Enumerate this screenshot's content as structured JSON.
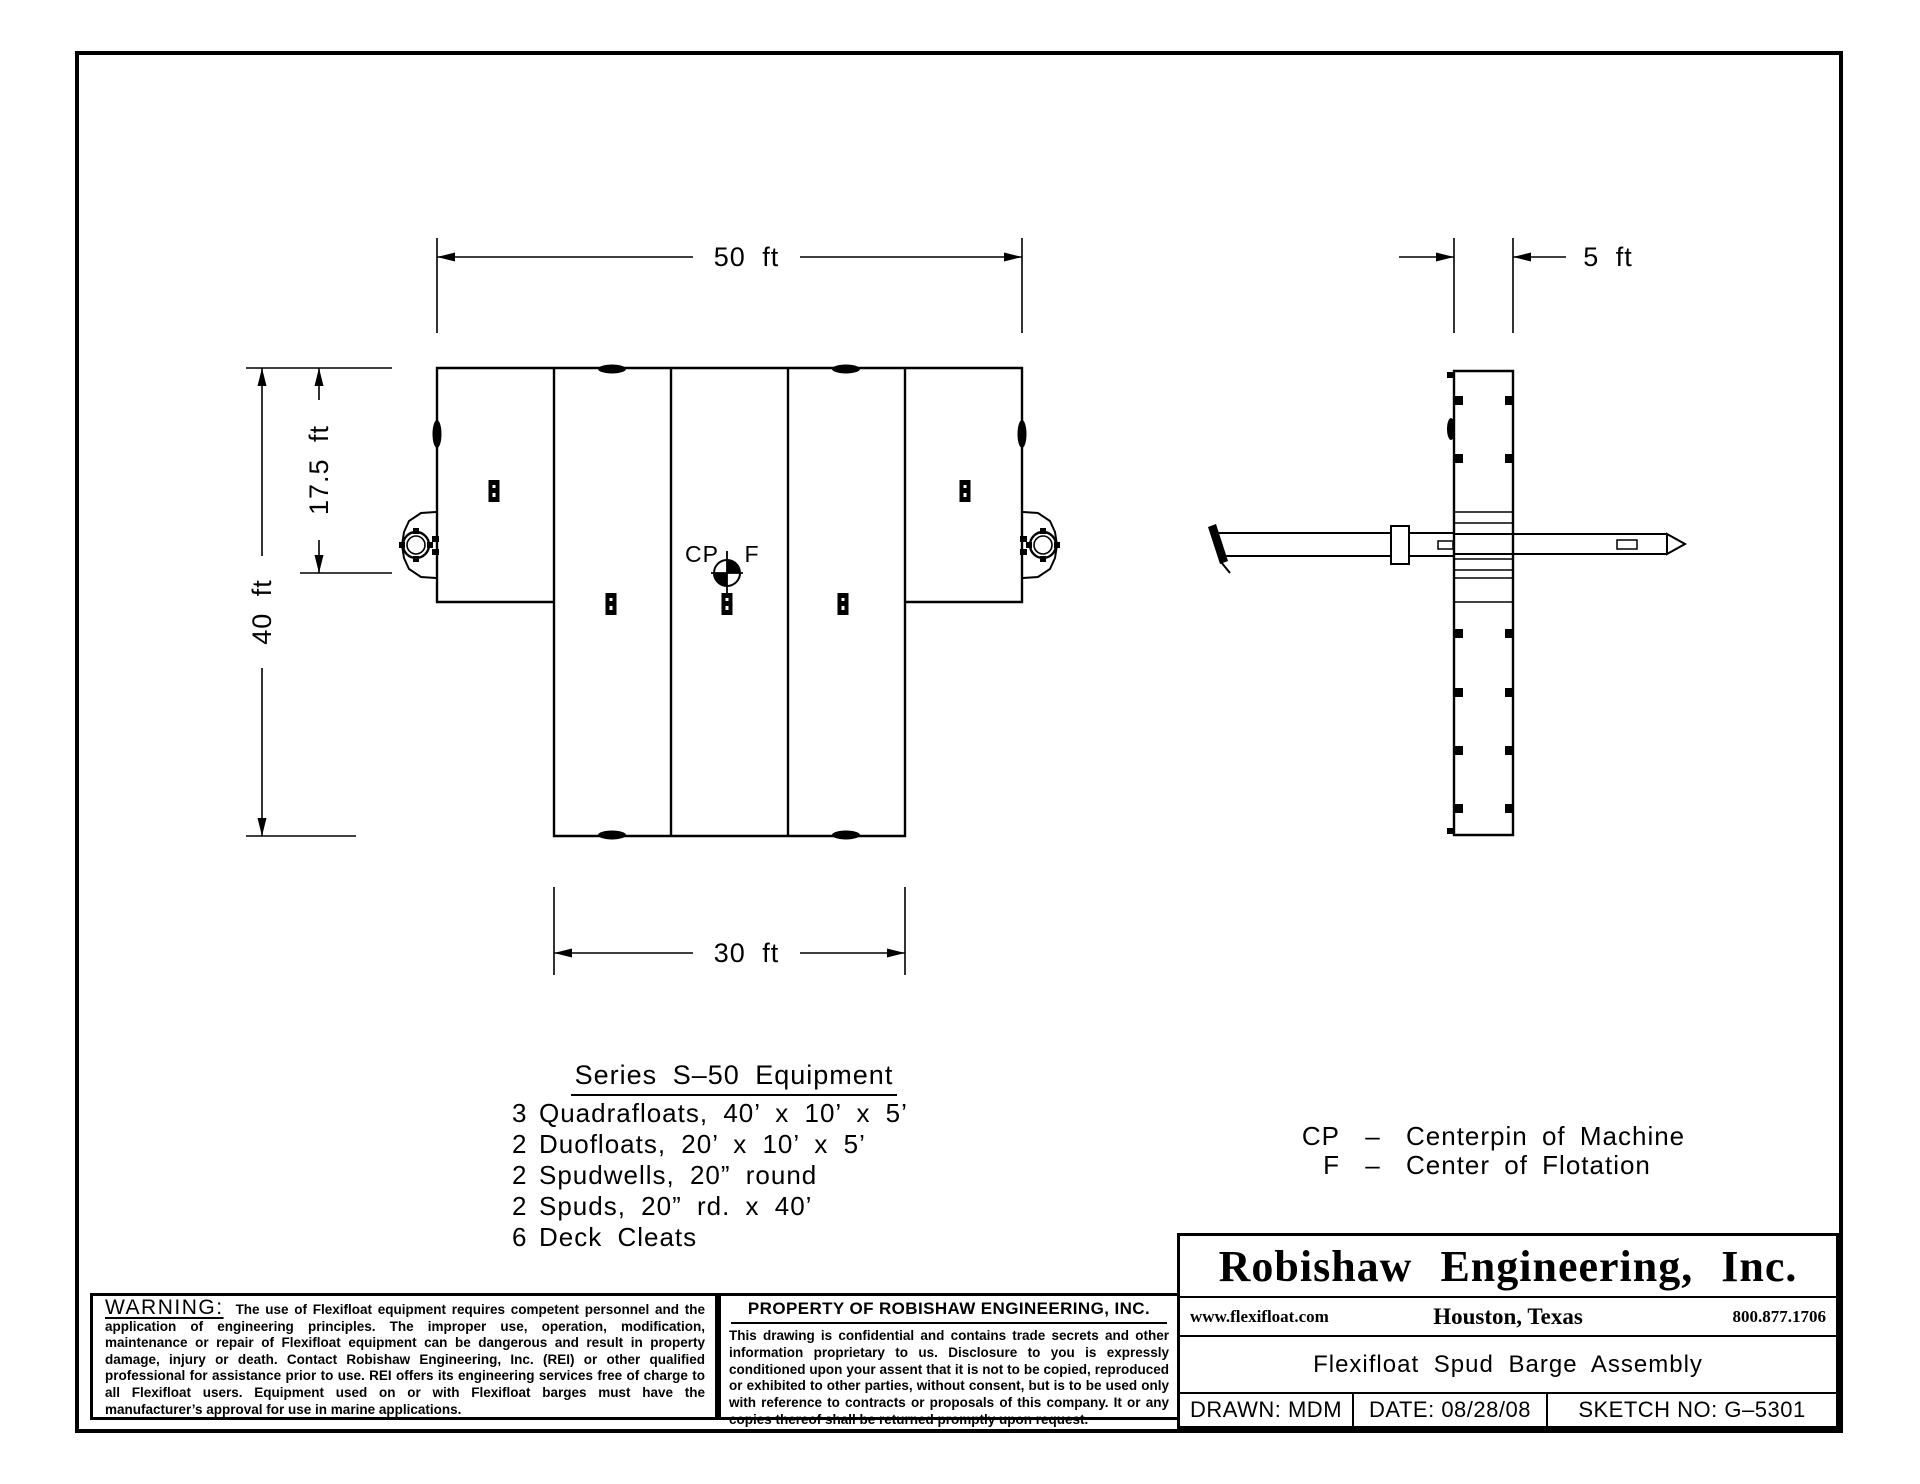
{
  "colors": {
    "ink": "#000000",
    "paper": "#ffffff"
  },
  "dimensions": {
    "overall_width": "50 ft",
    "barge_width": "5 ft",
    "overall_length": "40 ft",
    "spud_offset": "17.5 ft",
    "center_width": "30 ft"
  },
  "plan": {
    "centerpin_label": "CP",
    "flotation_label": "F"
  },
  "equipment": {
    "title": "Series S–50 Equipment",
    "items": [
      {
        "qty": "3",
        "desc": "Quadrafloats, 40’ x 10’ x 5’"
      },
      {
        "qty": "2",
        "desc": "Duofloats, 20’ x 10’ x 5’"
      },
      {
        "qty": "2",
        "desc": "Spudwells, 20” round"
      },
      {
        "qty": "2",
        "desc": "Spuds, 20” rd. x 40’"
      },
      {
        "qty": "6",
        "desc": "Deck Cleats"
      }
    ]
  },
  "legend": {
    "items": [
      {
        "abbr": "CP",
        "sep": "–",
        "desc": "Centerpin of Machine"
      },
      {
        "abbr": "F",
        "sep": "–",
        "desc": "Center of Flotation"
      }
    ]
  },
  "warning": {
    "title": "WARNING:",
    "body": "The use of Flexifloat equipment requires competent personnel and the application of engineering principles.  The improper use, operation, modification, maintenance or repair of Flexifloat equipment can be dangerous and result in property damage, injury or death.  Contact Robishaw Engineering, Inc. (REI) or other qualified professional for assistance prior to use.  REI offers its engineering services free of charge to all Flexifloat users. Equipment used on or with Flexifloat barges must have the manufacturer’s approval for use in marine applications."
  },
  "property_notice": {
    "title": "PROPERTY OF ROBISHAW ENGINEERING, INC.",
    "body": "This drawing is confidential and contains trade secrets and other information proprietary to us.  Disclosure to you is expressly conditioned upon your assent that it is not to be copied, reproduced or exhibited to other parties, without consent, but is to be used only with reference to contracts or proposals of this company. It or any copies thereof shall be returned promptly upon request."
  },
  "title_block": {
    "company": "Robishaw Engineering, Inc.",
    "website": "www.flexifloat.com",
    "location": "Houston, Texas",
    "phone": "800.877.1706",
    "drawing_title": "Flexifloat Spud Barge Assembly",
    "drawn": "DRAWN: MDM",
    "date": "DATE: 08/28/08",
    "sketch_no": "SKETCH NO: G–5301"
  }
}
